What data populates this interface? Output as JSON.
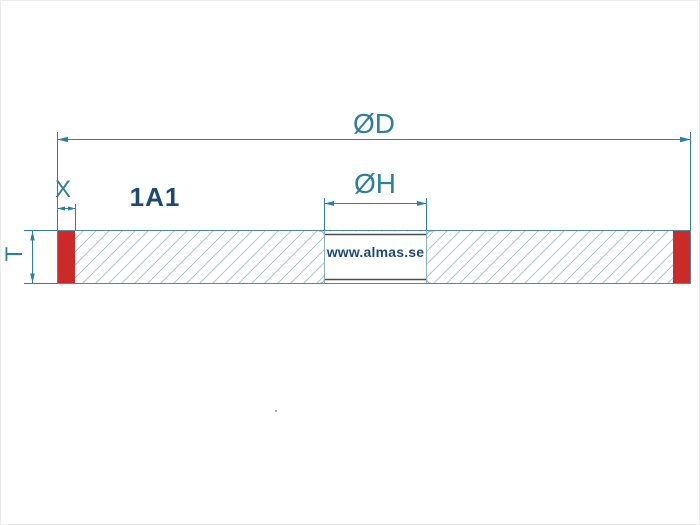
{
  "diagram": {
    "wheel_type": "1A1",
    "website": "www.almas.se",
    "dimension_labels": {
      "outer_diameter": "ØD",
      "hole_diameter": "ØH",
      "abrasive_width": "X",
      "thickness": "T"
    }
  },
  "colors": {
    "dimension": "#2e7f9f",
    "navy": "#1d4a74",
    "abrasive_red": "#cb2a28",
    "hatch": "#b0c5cf",
    "outline": "#4d8aa1",
    "hub_line": "#4d4d4d",
    "hub_wall": "#8fafbc",
    "artifact": "#a9a9a9"
  }
}
